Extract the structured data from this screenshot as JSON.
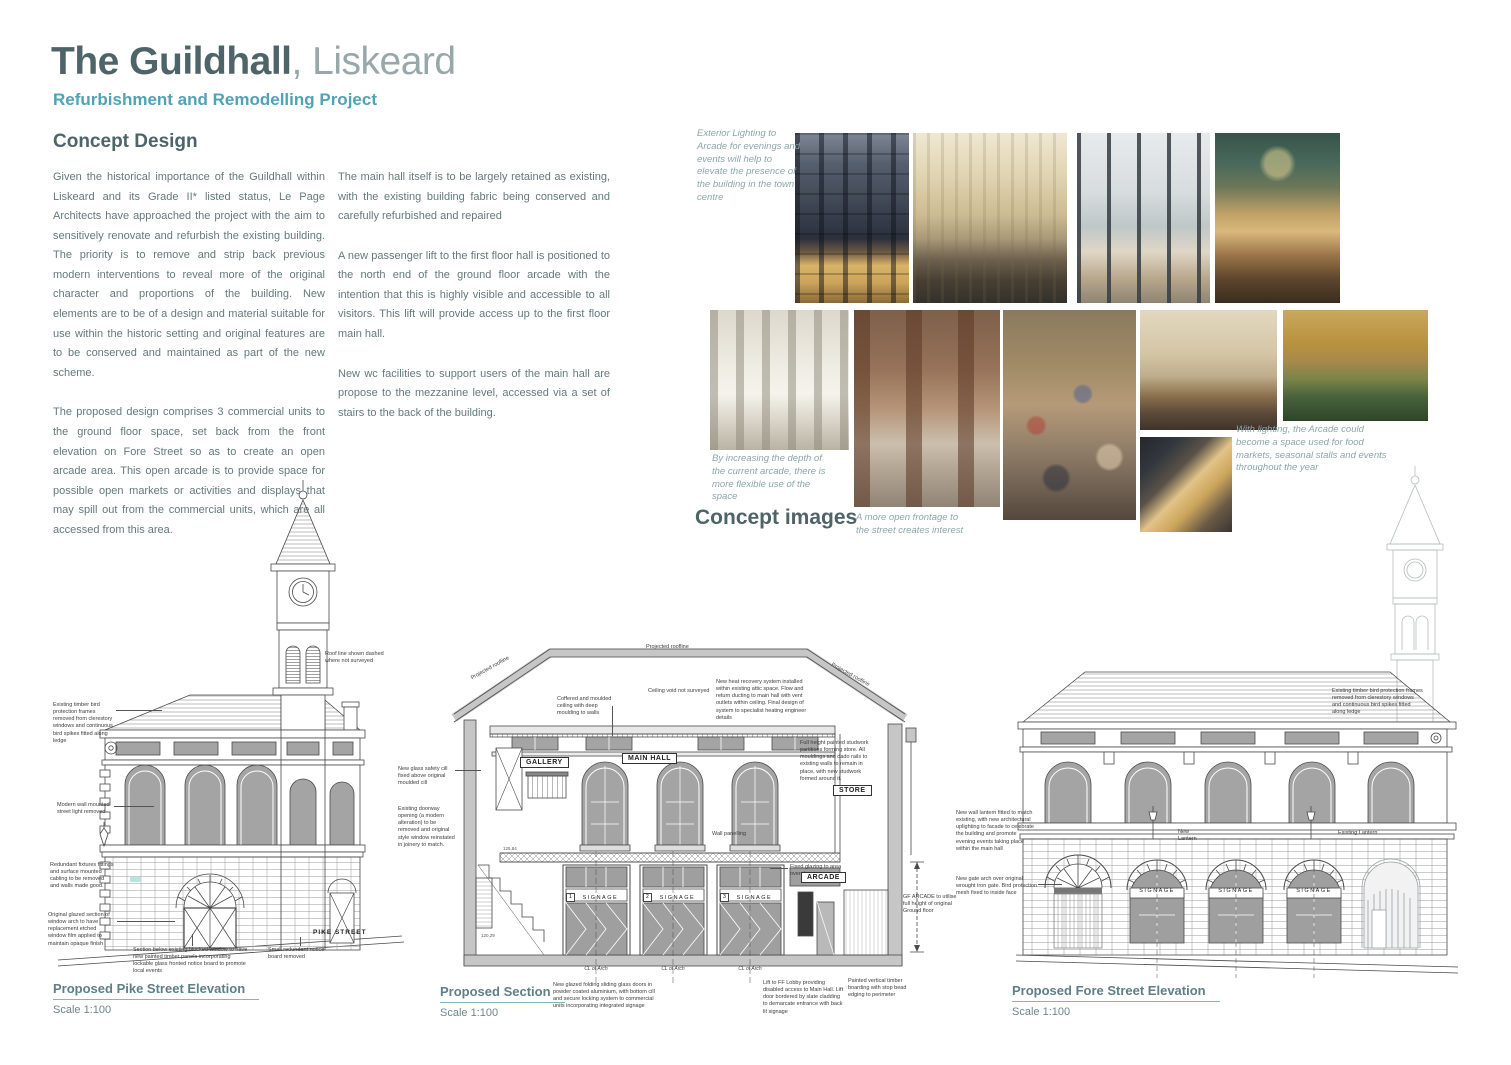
{
  "header": {
    "title_bold": "The Guildhall",
    "title_light": ", Liskeard",
    "subtitle": "Refurbishment and Remodelling Project",
    "section_heading": "Concept Design"
  },
  "intro": {
    "col1_p1": "Given the historical importance of the Guildhall within Liskeard and its Grade II* listed status, Le Page Architects have approached the project with the aim to sensitively renovate and refurbish the existing building.  The priority is to remove and strip back previous modern interventions to reveal more of the original character and proportions of the building. New elements are to be of a design and material suitable for use within the historic setting and original features are to be conserved and maintained as part of the new scheme.",
    "col1_p2": "The proposed design comprises 3 commercial units to the ground floor space, set back from the front elevation on Fore Street so as to create an open arcade area. This open arcade is to provide space for possible open markets or activities and displays that may spill out from the commercial units, which are all accessed from this area.",
    "col2_p1": "The main hall itself is to be largely retained as existing, with the existing building fabric being conserved and carefully refurbished and repaired",
    "col2_p2": "A new passenger lift to the first floor hall is positioned to the north end of the ground floor arcade with the intention that this is highly visible and accessible to all visitors.   This lift will provide access up to the first floor main hall.",
    "col2_p3": "New wc facilities to support users of the main hall are propose to the mezzanine level, accessed via a set of stairs to the back of the building."
  },
  "concept": {
    "heading": "Concept images",
    "annotations": {
      "lighting": "Exterior Lighting to Arcade for evenings and events will help to elevate the presence of the building in the town centre",
      "depth": "By increasing the depth of the current arcade, there is more flexible use of the space",
      "frontage": "A more open frontage to the street creates interest",
      "market": "With lighting, the Arcade could become a space used for food markets, seasonal stalls and events throughout the year"
    }
  },
  "drawings": {
    "pike": {
      "title": "Proposed Pike Street Elevation",
      "scale": "Scale 1:100",
      "street_label": "PIKE STREET",
      "annotations": [
        "Existing timber bird protection frames removed from clerestory windows and continuous bird spikes fitted along ledge",
        "Modern wall mounted street light removed",
        "Redundant fixtures fittings and surface mounted cabling to be removed and walls made good.",
        "Original glazed section of window arch to have replacement etched window film applied to maintain opaque finish",
        "Roof line shown dashed where not surveyed",
        "Section below existing blocked window to have new painted timber panels incorporating lockable glass fronted notice board to promote local events",
        "Small redundant notice board removed"
      ]
    },
    "section": {
      "title": "Proposed Section",
      "scale": "Scale 1:100",
      "roofline_label": "Projected roofline",
      "cl_label": "CL of Arch",
      "signage_label": "SIGNAGE",
      "units": [
        "1",
        "2",
        "3"
      ],
      "levels": [
        "125,84",
        "120,29"
      ],
      "room_labels": {
        "gallery": "GALLERY",
        "main_hall": "MAIN HALL",
        "store": "STORE",
        "arcade": "ARCADE"
      },
      "annotations": [
        "Ceiling void not surveyed",
        "Coffered and moulded ceiling with deep moulding to walls",
        "New heat recovery system installed within existing attic space.  Flow and return ducting to main hall with vent outlets within ceiling.  Final design of system to specialist heating engineer details",
        "Full height painted studwork partitions forming store.  All mouldings and dado rails to existing walls to remain in place, with new studwork formed around it.",
        "New glass safety cill fixed above original moulded cill",
        "Existing doorway opening (a modern alteration) to be removed and original style window reinstated in joinery to match.",
        "Wall panelling",
        "Fixed glazing to area over doors",
        "New glazed folding sliding glass doors in powder coated aluminium, with bottom cill and secure locking system to commercial units incorporating integrated signage",
        "Lift to FF Lobby providing disabled access to Main Hall.  Lift door bordered by slate cladding to demarcate entrance with back lit signage",
        "Painted vertical timber boarding with stop bead edging to perimeter",
        "GF ARCADE to utilise full height of original Ground floor"
      ]
    },
    "fore": {
      "title": "Proposed Fore Street Elevation",
      "scale": "Scale 1:100",
      "signage_label": "SIGNAGE",
      "annotations": [
        "Existing timber bird protection frames removed from clerestory windows and continuous bird spikes fitted along ledge",
        "New wall lantern fitted to match existing, with new architectural uplighting to facade to celebrate the building and promote evening events taking place within the main hall",
        "New gate arch over original wrought iron gate.  Bird protection mesh fixed to inside face",
        "New Lantern",
        "Existing Lantern"
      ]
    }
  },
  "colors": {
    "accent_teal": "#4fa3b5",
    "heading": "#4e6468",
    "body_text": "#64797d",
    "handwriting": "#8ba6ab",
    "caption": "#5e7f86",
    "caption_underline": "#82b7c1"
  }
}
